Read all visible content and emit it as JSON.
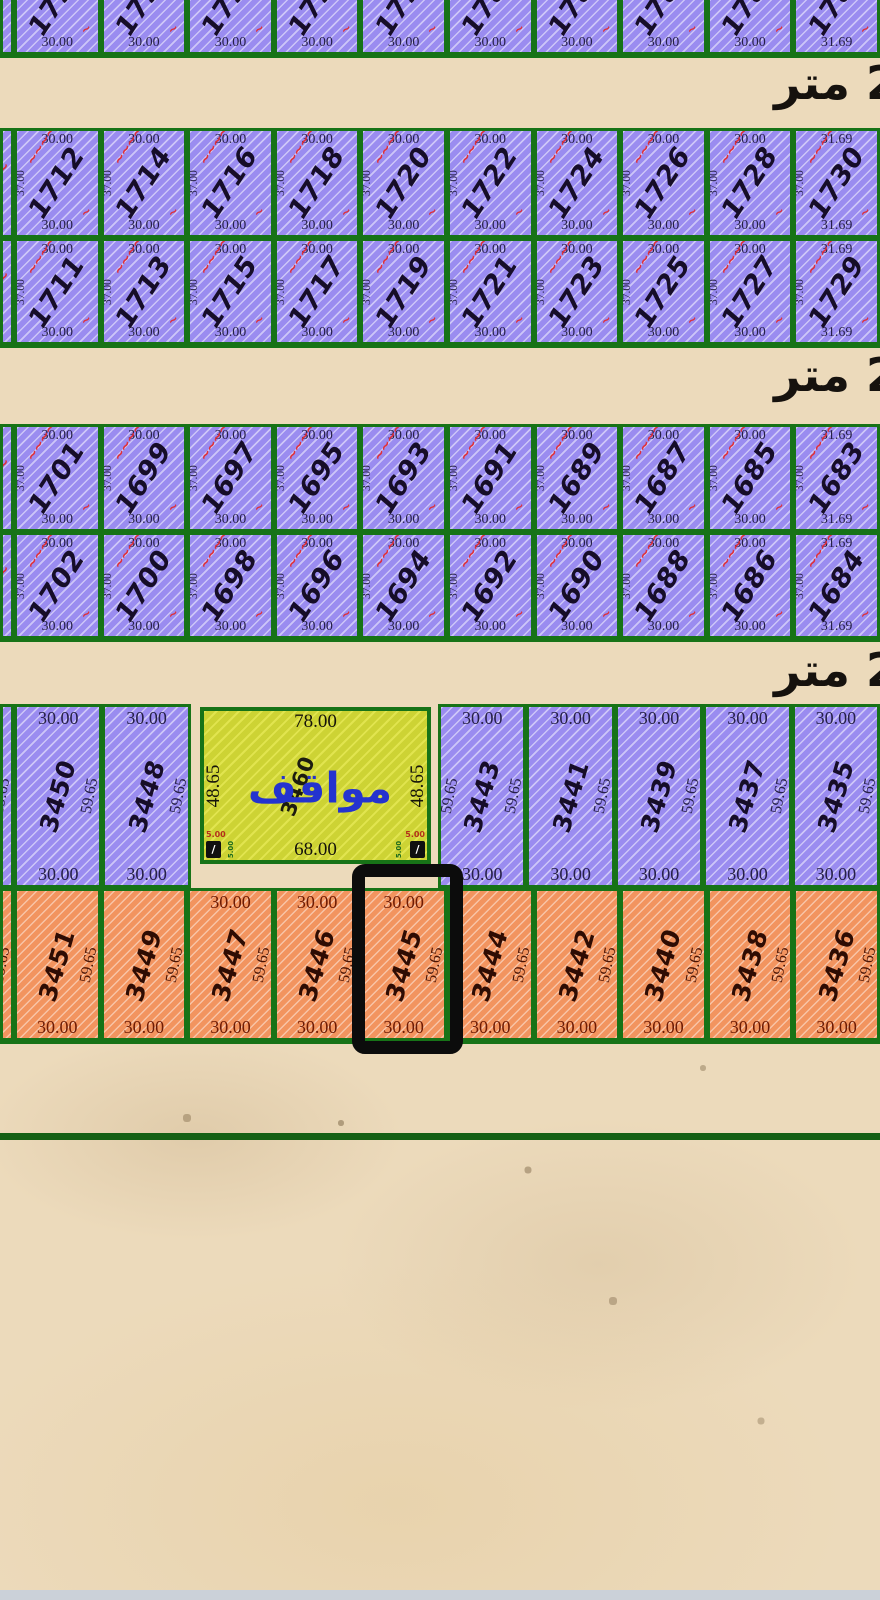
{
  "map": {
    "street_label": "2 متر",
    "plot_width_dim": "30.00",
    "plot_width_dim_last_col": "31.69",
    "upper_side_dim": "37.00",
    "lower_side_dim": "59.65",
    "annotation_scribble": "~~~~",
    "annotation_flourish": "~",
    "upper_rows": [
      {
        "id": "row-1790s-partial",
        "numbers": [
          "1798",
          "1796",
          "1794",
          "1792",
          "1790",
          "1788",
          "1786",
          "1784",
          "1782",
          "1780"
        ]
      },
      {
        "id": "row-1712-1730",
        "numbers": [
          "1712",
          "1714",
          "1716",
          "1718",
          "1720",
          "1722",
          "1724",
          "1726",
          "1728",
          "1730"
        ]
      },
      {
        "id": "row-1711-1729",
        "numbers": [
          "1711",
          "1713",
          "1715",
          "1717",
          "1719",
          "1721",
          "1723",
          "1725",
          "1727",
          "1729"
        ]
      },
      {
        "id": "row-1701-1683",
        "numbers": [
          "1701",
          "1699",
          "1697",
          "1695",
          "1693",
          "1691",
          "1689",
          "1687",
          "1685",
          "1683"
        ]
      },
      {
        "id": "row-1702-1684",
        "numbers": [
          "1702",
          "1700",
          "1698",
          "1696",
          "1694",
          "1692",
          "1690",
          "1688",
          "1686",
          "1684"
        ]
      }
    ],
    "lower_purple_numbers": [
      "3450",
      "3448",
      "3443",
      "3441",
      "3439",
      "3437",
      "3435"
    ],
    "lower_orange_numbers": [
      "3451",
      "3449",
      "3447",
      "3446",
      "3445",
      "3444",
      "3442",
      "3440",
      "3438",
      "3436"
    ],
    "selected_plot": "3445",
    "parking": {
      "number": "3460",
      "label": "مواقف",
      "top_dim": "78.00",
      "bottom_dim": "68.00",
      "side_dim": "48.65",
      "chamfer_dim": "5.00"
    },
    "colors": {
      "plot_purple": "#9a8cf0",
      "plot_orange": "#f2945f",
      "parking_yellow": "#cdd334",
      "border_green": "#177317",
      "highlight_black": "#0c0c0c",
      "parking_text_blue": "#2433cf",
      "annotation_red": "#e03038",
      "dim_text_purple": "#262047",
      "dim_text_orange": "#6e1b04",
      "number_text_purple": "#160d28",
      "number_text_orange": "#2e0c03"
    }
  }
}
